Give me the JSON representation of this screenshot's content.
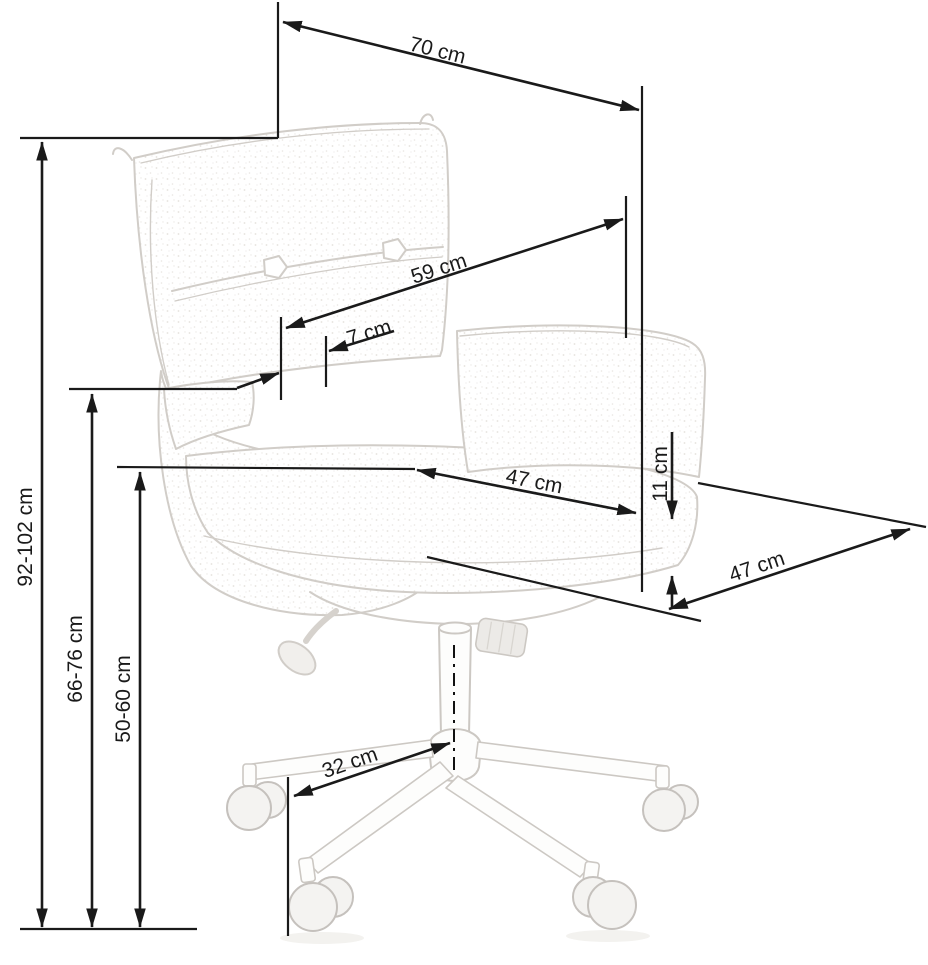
{
  "diagram": {
    "subject": "office chair dimension drawing",
    "unit": "cm",
    "line_color": "#1a1a1a",
    "sketch_color": "#d1cdc8",
    "dimensions": {
      "overall_height": {
        "label": "92-102 cm",
        "min": 92,
        "max": 102
      },
      "top_width": {
        "label": "70 cm",
        "value": 70
      },
      "backrest_width": {
        "label": "59 cm",
        "value": 59
      },
      "backrest_armrest_gap": {
        "label": "7 cm",
        "value": 7
      },
      "seat_depth": {
        "label": "47 cm",
        "value": 47
      },
      "cushion_thickness": {
        "label": "11 cm",
        "value": 11
      },
      "seat_width": {
        "label": "47 cm",
        "value": 47
      },
      "armrest_height": {
        "label": "66-76 cm",
        "min": 66,
        "max": 76
      },
      "seat_height": {
        "label": "50-60 cm",
        "min": 50,
        "max": 60
      },
      "base_arm_length": {
        "label": "32 cm",
        "value": 32
      }
    }
  }
}
